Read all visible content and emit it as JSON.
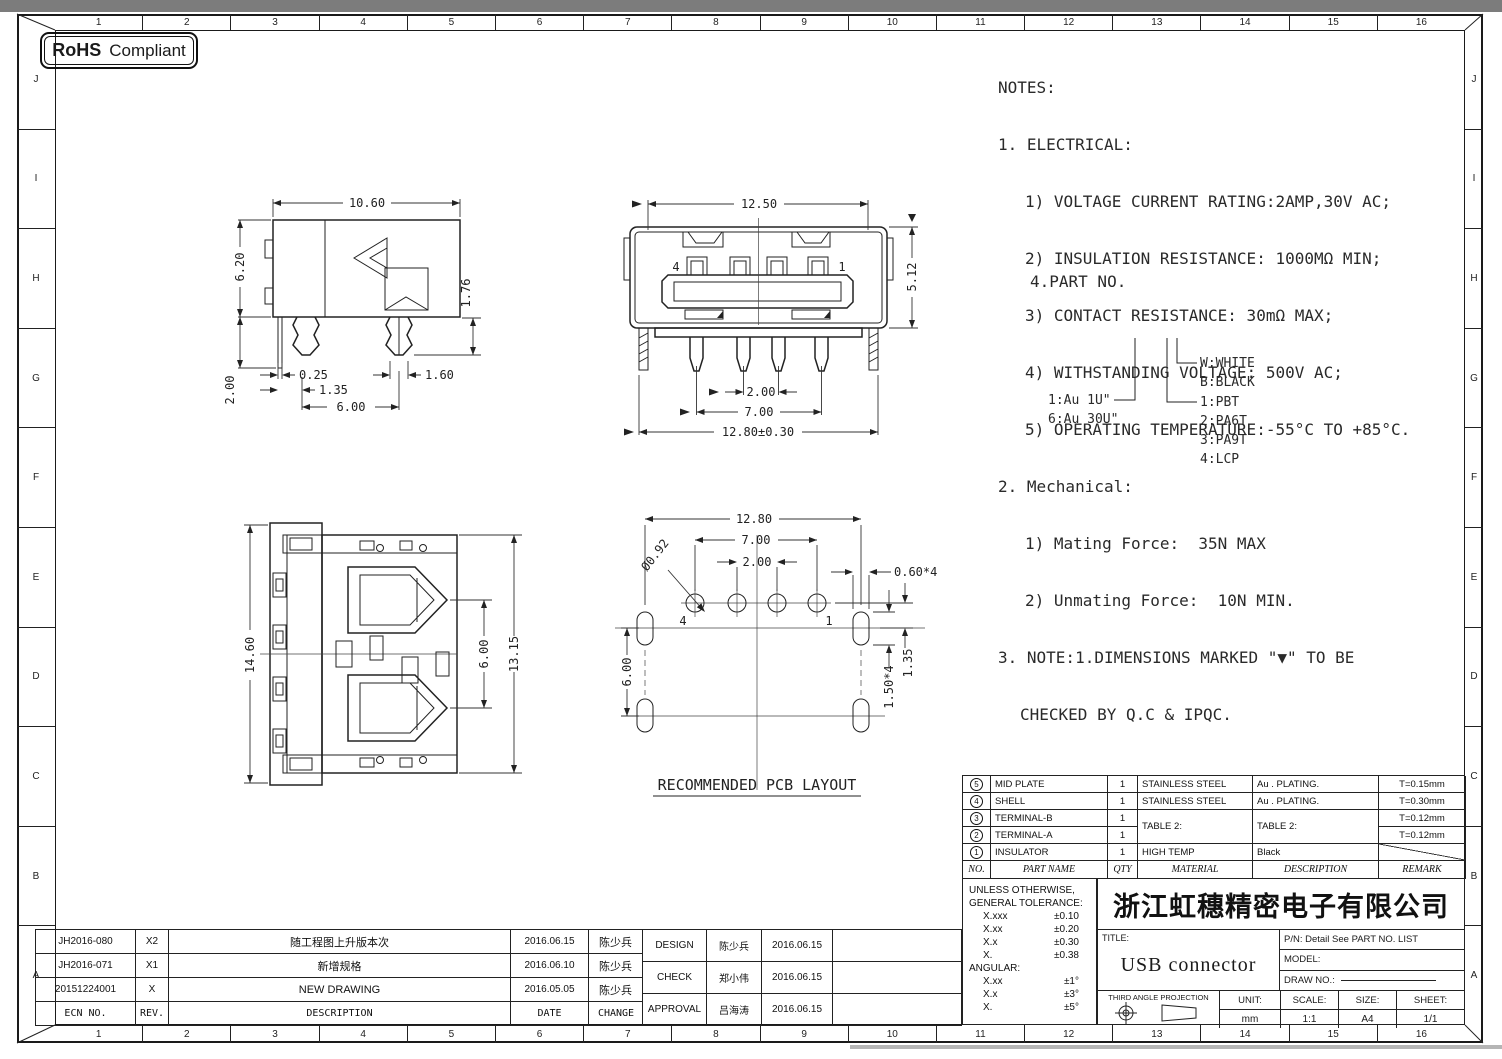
{
  "rohs": {
    "bold": "RoHS",
    "rest": "Compliant"
  },
  "border": {
    "cols": [
      "1",
      "2",
      "3",
      "4",
      "5",
      "6",
      "7",
      "8",
      "9",
      "10",
      "11",
      "12",
      "13",
      "14",
      "15",
      "16"
    ],
    "rows": [
      "J",
      "I",
      "H",
      "G",
      "F",
      "E",
      "D",
      "C",
      "B",
      "A"
    ]
  },
  "notes": {
    "l0": "NOTES:",
    "l1": "1. ELECTRICAL:",
    "l2": "1) VOLTAGE CURRENT RATING:2AMP,30V AC;",
    "l3": "2) INSULATION RESISTANCE: 1000MΩ MIN;",
    "l4": "3) CONTACT RESISTANCE: 30mΩ MAX;",
    "l5": "4) WITHSTANDING VOLTAGE: 500V AC;",
    "l6": "5) OPERATING TEMPERATURE:-55°C TO +85°C.",
    "l7": "2. Mechanical:",
    "l8": "1) Mating Force:  35N MAX",
    "l9": "2) Unmating Force:  10N MIN.",
    "l10": "3. NOTE:1.DIMENSIONS MARKED \"▼\" TO BE",
    "l11": "CHECKED BY Q.C & IPQC.",
    "part_no_heading": "4.PART NO."
  },
  "part_tree": {
    "au1": "1:Au 1U\"",
    "au6": "6:Au 30U\"",
    "w": "W:WHITE",
    "b": "B:BLACK",
    "m1": "1:PBT",
    "m2": "2:PA6T",
    "m3": "3:PA9T",
    "m4": "4:LCP"
  },
  "drawings": {
    "side_view": {
      "width": "10.60",
      "height": "6.20",
      "leg": "2.00",
      "pin_height": "1.76",
      "d_025": "0.25",
      "d_135": "1.35",
      "d_160": "1.60",
      "d_600": "6.00"
    },
    "front_view": {
      "width": "12.50",
      "height": "5.12",
      "pitch": "2.00",
      "span": "7.00",
      "overall": "12.80±0.30",
      "pin4": "4",
      "pin1": "1"
    },
    "top_view": {
      "height": "14.60",
      "d_600": "6.00",
      "d_1315": "13.15"
    },
    "pcb": {
      "title": "RECOMMENDED PCB LAYOUT",
      "d_1280": "12.80",
      "d_700": "7.00",
      "d_200": "2.00",
      "hole": "Ø0.92",
      "d_060": "0.60*4",
      "d_135": "1.35",
      "d_150": "1.50*4",
      "d_600": "6.00",
      "pin4": "4",
      "pin1": "1"
    }
  },
  "parts": {
    "headers": [
      "NO.",
      "PART NAME",
      "QTY",
      "MATERIAL",
      "DESCRIPTION",
      "REMARK"
    ],
    "rows": [
      {
        "no": "5",
        "name": "MID PLATE",
        "qty": "1",
        "material": "STAINLESS STEEL",
        "description": "Au . PLATING.",
        "remark": "T=0.15mm"
      },
      {
        "no": "4",
        "name": "SHELL",
        "qty": "1",
        "material": "STAINLESS STEEL",
        "description": "Au . PLATING.",
        "remark": "T=0.30mm"
      },
      {
        "no": "3",
        "name": "TERMINAL-B",
        "qty": "1",
        "material": "TABLE 2:",
        "description": "TABLE 2:",
        "remark": "T=0.12mm"
      },
      {
        "no": "2",
        "name": "TERMINAL-A",
        "qty": "1",
        "material": "",
        "description": "",
        "remark": "T=0.12mm"
      },
      {
        "no": "1",
        "name": "INSULATOR",
        "qty": "1",
        "material": "HIGH TEMP",
        "description": "Black",
        "remark": ""
      }
    ]
  },
  "tolerance": {
    "l1": "UNLESS OTHERWISE,",
    "l2": "GENERAL TOLERANCE:",
    "rows": [
      [
        "X.xxx",
        "±0.10"
      ],
      [
        "X.xx",
        "±0.20"
      ],
      [
        "X.x",
        "±0.30"
      ],
      [
        "X.",
        "±0.38"
      ]
    ],
    "angular": "ANGULAR:",
    "arows": [
      [
        "X.xx",
        "±1°"
      ],
      [
        "X.x",
        "±3°"
      ],
      [
        "X.",
        "±5°"
      ]
    ]
  },
  "title_block": {
    "company": "浙江虹穗精密电子有限公司",
    "title_label": "TITLE:",
    "title": "USB connector",
    "pn": "P/N: Detail See PART NO. LIST",
    "model_label": "MODEL:",
    "draw_no_label": "DRAW NO.:",
    "projection": "THIRD ANGLE PROJECTION",
    "unit_label": "UNIT:",
    "unit": "mm",
    "scale_label": "SCALE:",
    "scale": "1:1",
    "size_label": "SIZE:",
    "size": "A4",
    "sheet_label": "SHEET:",
    "sheet": "1/1"
  },
  "revision": {
    "headers": [
      "ECN NO.",
      "REV.",
      "DESCRIPTION",
      "DATE",
      "CHANGE"
    ],
    "rows": [
      {
        "ecn": "JH2016-080",
        "rev": "X2",
        "desc": "随工程图上升版本次",
        "date": "2016.06.15",
        "by": "陈少兵"
      },
      {
        "ecn": "JH2016-071",
        "rev": "X1",
        "desc": "新增规格",
        "date": "2016.06.10",
        "by": "陈少兵"
      },
      {
        "ecn": "20151224001",
        "rev": "X",
        "desc": "NEW DRAWING",
        "date": "2016.05.05",
        "by": "陈少兵"
      }
    ]
  },
  "approval": {
    "rows": [
      {
        "role": "DESIGN",
        "name": "陈少兵",
        "date": "2016.06.15"
      },
      {
        "role": "CHECK",
        "name": "郑小伟",
        "date": "2016.06.15"
      },
      {
        "role": "APPROVAL",
        "name": "吕海涛",
        "date": "2016.06.15"
      }
    ]
  }
}
